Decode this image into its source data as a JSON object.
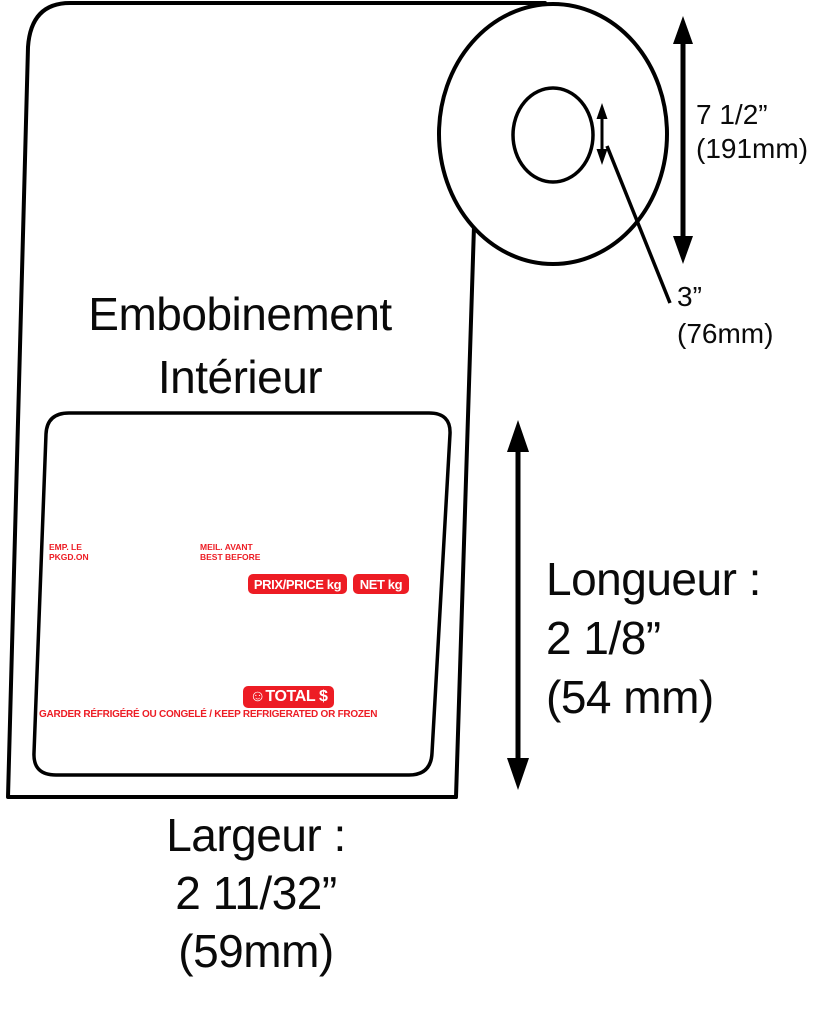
{
  "diagram": {
    "title_line1": "Embobinement",
    "title_line2": "Intérieur",
    "roll": {
      "outer_diameter_in": "7 1/2”",
      "outer_diameter_mm": "(191mm)",
      "core_diameter_in": "3”",
      "core_diameter_mm": "(76mm)"
    },
    "dimensions": {
      "length_label": "Longueur :",
      "length_in": "2 1/8”",
      "length_mm": "(54 mm)",
      "width_label": "Largeur :",
      "width_in": "2 11/32”",
      "width_mm": "(59mm)"
    },
    "label_content": {
      "packed_on_line1": "EMP. LE",
      "packed_on_line2": "PKGD.ON",
      "best_before_line1": "MEIL. AVANT",
      "best_before_line2": "BEST BEFORE",
      "price_badge": "PRIX/PRICE kg",
      "net_badge": "NET kg",
      "total_badge": "☺TOTAL $",
      "storage_notice": "GARDER RÉFRIGÉRÉ OU CONGELÉ / KEEP REFRIGERATED OR FROZEN"
    },
    "colors": {
      "label_red": "#ed1c24",
      "line_black": "#000000"
    }
  }
}
